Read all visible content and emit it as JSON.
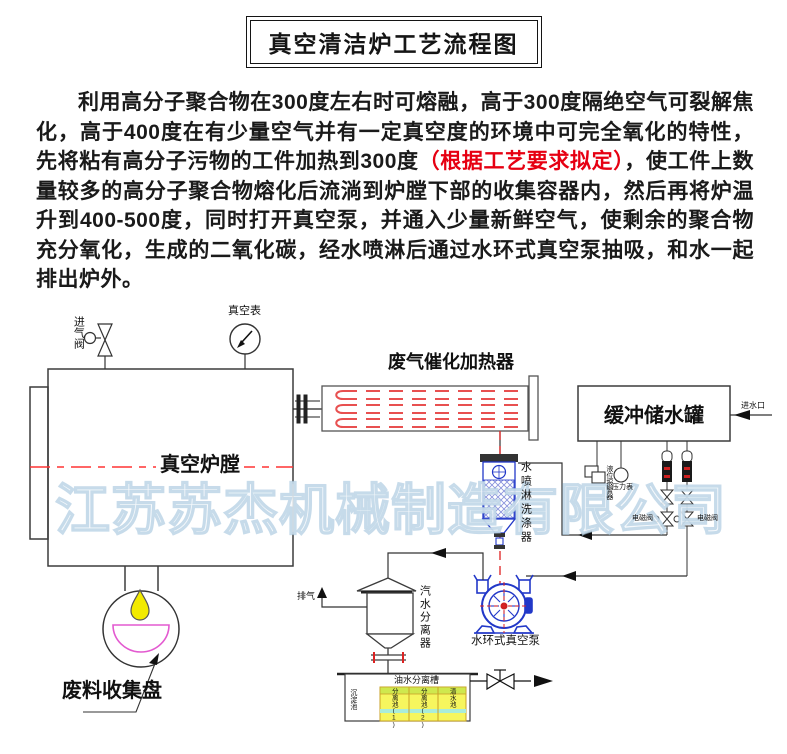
{
  "title": "真空清洁炉工艺流程图",
  "intro": {
    "text_before_red": "利用高分子聚合物在300度左右时可熔融，高于300度隔绝空气可裂解焦化，高于400度在有少量空气并有一定真空度的环境中可完全氧化的特性，先将粘有高分子污物的工件加热到300度",
    "red_text": "（根据工艺要求拟定）",
    "text_after_red": "，使工件上数量较多的高分子聚合物熔化后流淌到炉膛下部的收集容器内，然后再将炉温升到400-500度，同时打开真空泵，并通入少量新鲜空气，使剩余的聚合物充分氧化，生成的二氧化碳，经水喷淋后通过水环式真空泵抽吸，和水一起排出炉外。"
  },
  "diagram": {
    "watermark": "江苏苏杰机械制造有限公司",
    "labels": {
      "furnace": "真空炉膛",
      "intake_valve": "进气阀",
      "vacuum_gauge": "真空表",
      "catalytic_heater": "废气催化加热器",
      "buffer_tank": "缓冲储水罐",
      "water_inlet": "进水口",
      "level_alarm": "液位报警器",
      "pressure_gauge": "压力表",
      "solenoid_valve_left": "电磁阀",
      "solenoid_valve_right": "电磁阀",
      "scrubber": "水喷淋洗涤器",
      "steam_water_separator": "汽水分离器",
      "exhaust": "排气",
      "vacuum_pump": "水环式真空泵",
      "waste_pan": "废料收集盘",
      "oil_water_tank": "油水分离槽",
      "settling_cell": "沉淀池",
      "separation_cell_1": "分离池(1)",
      "separation_cell_2": "分离池(2)",
      "clean_water_cell": "清水池"
    },
    "colors": {
      "red_accent": "#e60012",
      "centerline_red": "#ff3333",
      "heater_element_red": "#e85050",
      "equipment_blue": "#2238c8",
      "pan_magenta": "#e35ad0",
      "drop_yellow": "#f2ea00",
      "cell_yellow": "#f6f65e",
      "cell_cyan": "#a9ecd9"
    }
  }
}
